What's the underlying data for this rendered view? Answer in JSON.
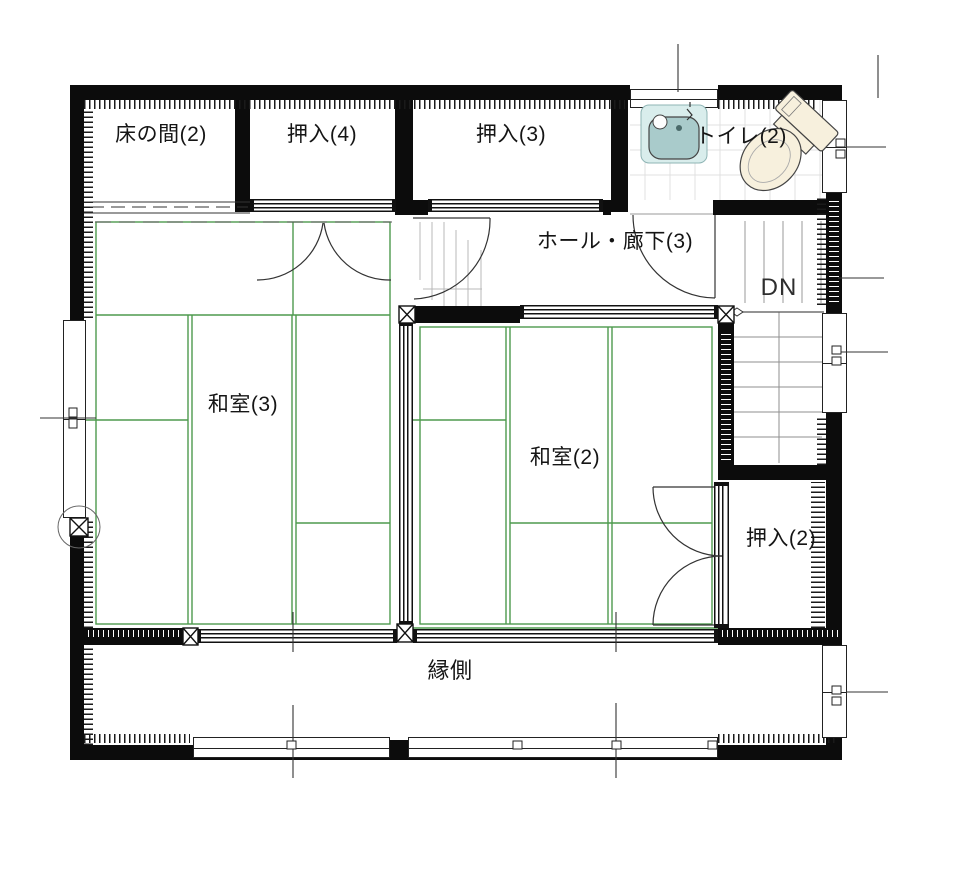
{
  "plan_title": "2F floor plan",
  "rooms": {
    "tokonoma": {
      "label": "床の間(2)"
    },
    "oshiire4": {
      "label": "押入(4)"
    },
    "oshiire3": {
      "label": "押入(3)"
    },
    "toilet": {
      "label": "トイレ(2)"
    },
    "hall": {
      "label": "ホール・廊下(3)"
    },
    "washitsu3": {
      "label": "和室(3)"
    },
    "washitsu2": {
      "label": "和室(2)"
    },
    "oshiire2": {
      "label": "押入(2)"
    },
    "engawa": {
      "label": "縁側"
    }
  },
  "stairs": {
    "down_label": "DN"
  },
  "colors": {
    "wall": "#0c0c0c",
    "tatami_line": "#4e9a4e",
    "tread": "#8f8f8f",
    "faint": "#b8b8b8",
    "tick": "#333333",
    "tile_grid": "#e0e0e0",
    "sink_panel": "#d9edec",
    "sink_bowl": "#a9cbcb",
    "toilet_fill": "#f7f0dd",
    "fixture_outline": "#444444"
  }
}
